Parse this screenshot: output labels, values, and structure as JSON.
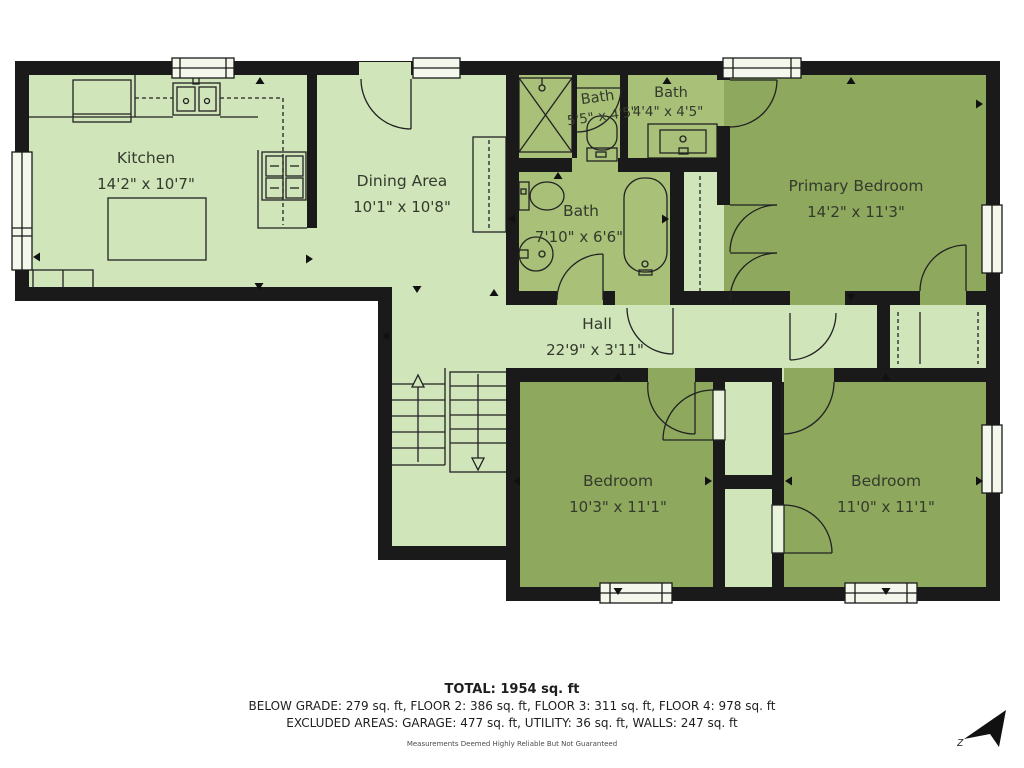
{
  "plan": {
    "rooms": [
      {
        "name": "Kitchen",
        "dims": "14'2\" x 10'7\""
      },
      {
        "name": "Dining Area",
        "dims": "10'1\" x 10'8\""
      },
      {
        "name": "Bath",
        "dims": "5'5\" x 4'5\""
      },
      {
        "name": "Bath",
        "dims": "4'4\" x 4'5\""
      },
      {
        "name": "Bath",
        "dims": "7'10\" x 6'6\""
      },
      {
        "name": "Primary Bedroom",
        "dims": "14'2\" x 11'3\""
      },
      {
        "name": "Hall",
        "dims": "22'9\" x 3'11\""
      },
      {
        "name": "Bedroom",
        "dims": "10'3\" x 11'1\""
      },
      {
        "name": "Bedroom",
        "dims": "11'0\" x 11'1\""
      }
    ],
    "compass_label": "z"
  },
  "summary": {
    "total": "TOTAL: 1954 sq. ft",
    "floors": "BELOW GRADE: 279 sq. ft, FLOOR 2: 386 sq. ft, FLOOR 3: 311 sq. ft, FLOOR 4: 978 sq. ft",
    "excluded": "EXCLUDED AREAS: GARAGE: 477 sq. ft, UTILITY: 36 sq. ft, WALLS: 247 sq. ft",
    "disclaimer": "Measurements Deemed Highly Reliable But Not Guaranteed"
  },
  "colors": {
    "floor_light": "#d0e5ba",
    "floor_bath": "#a8c078",
    "floor_bedroom": "#8ea85e",
    "wall": "#1a1a1a"
  }
}
